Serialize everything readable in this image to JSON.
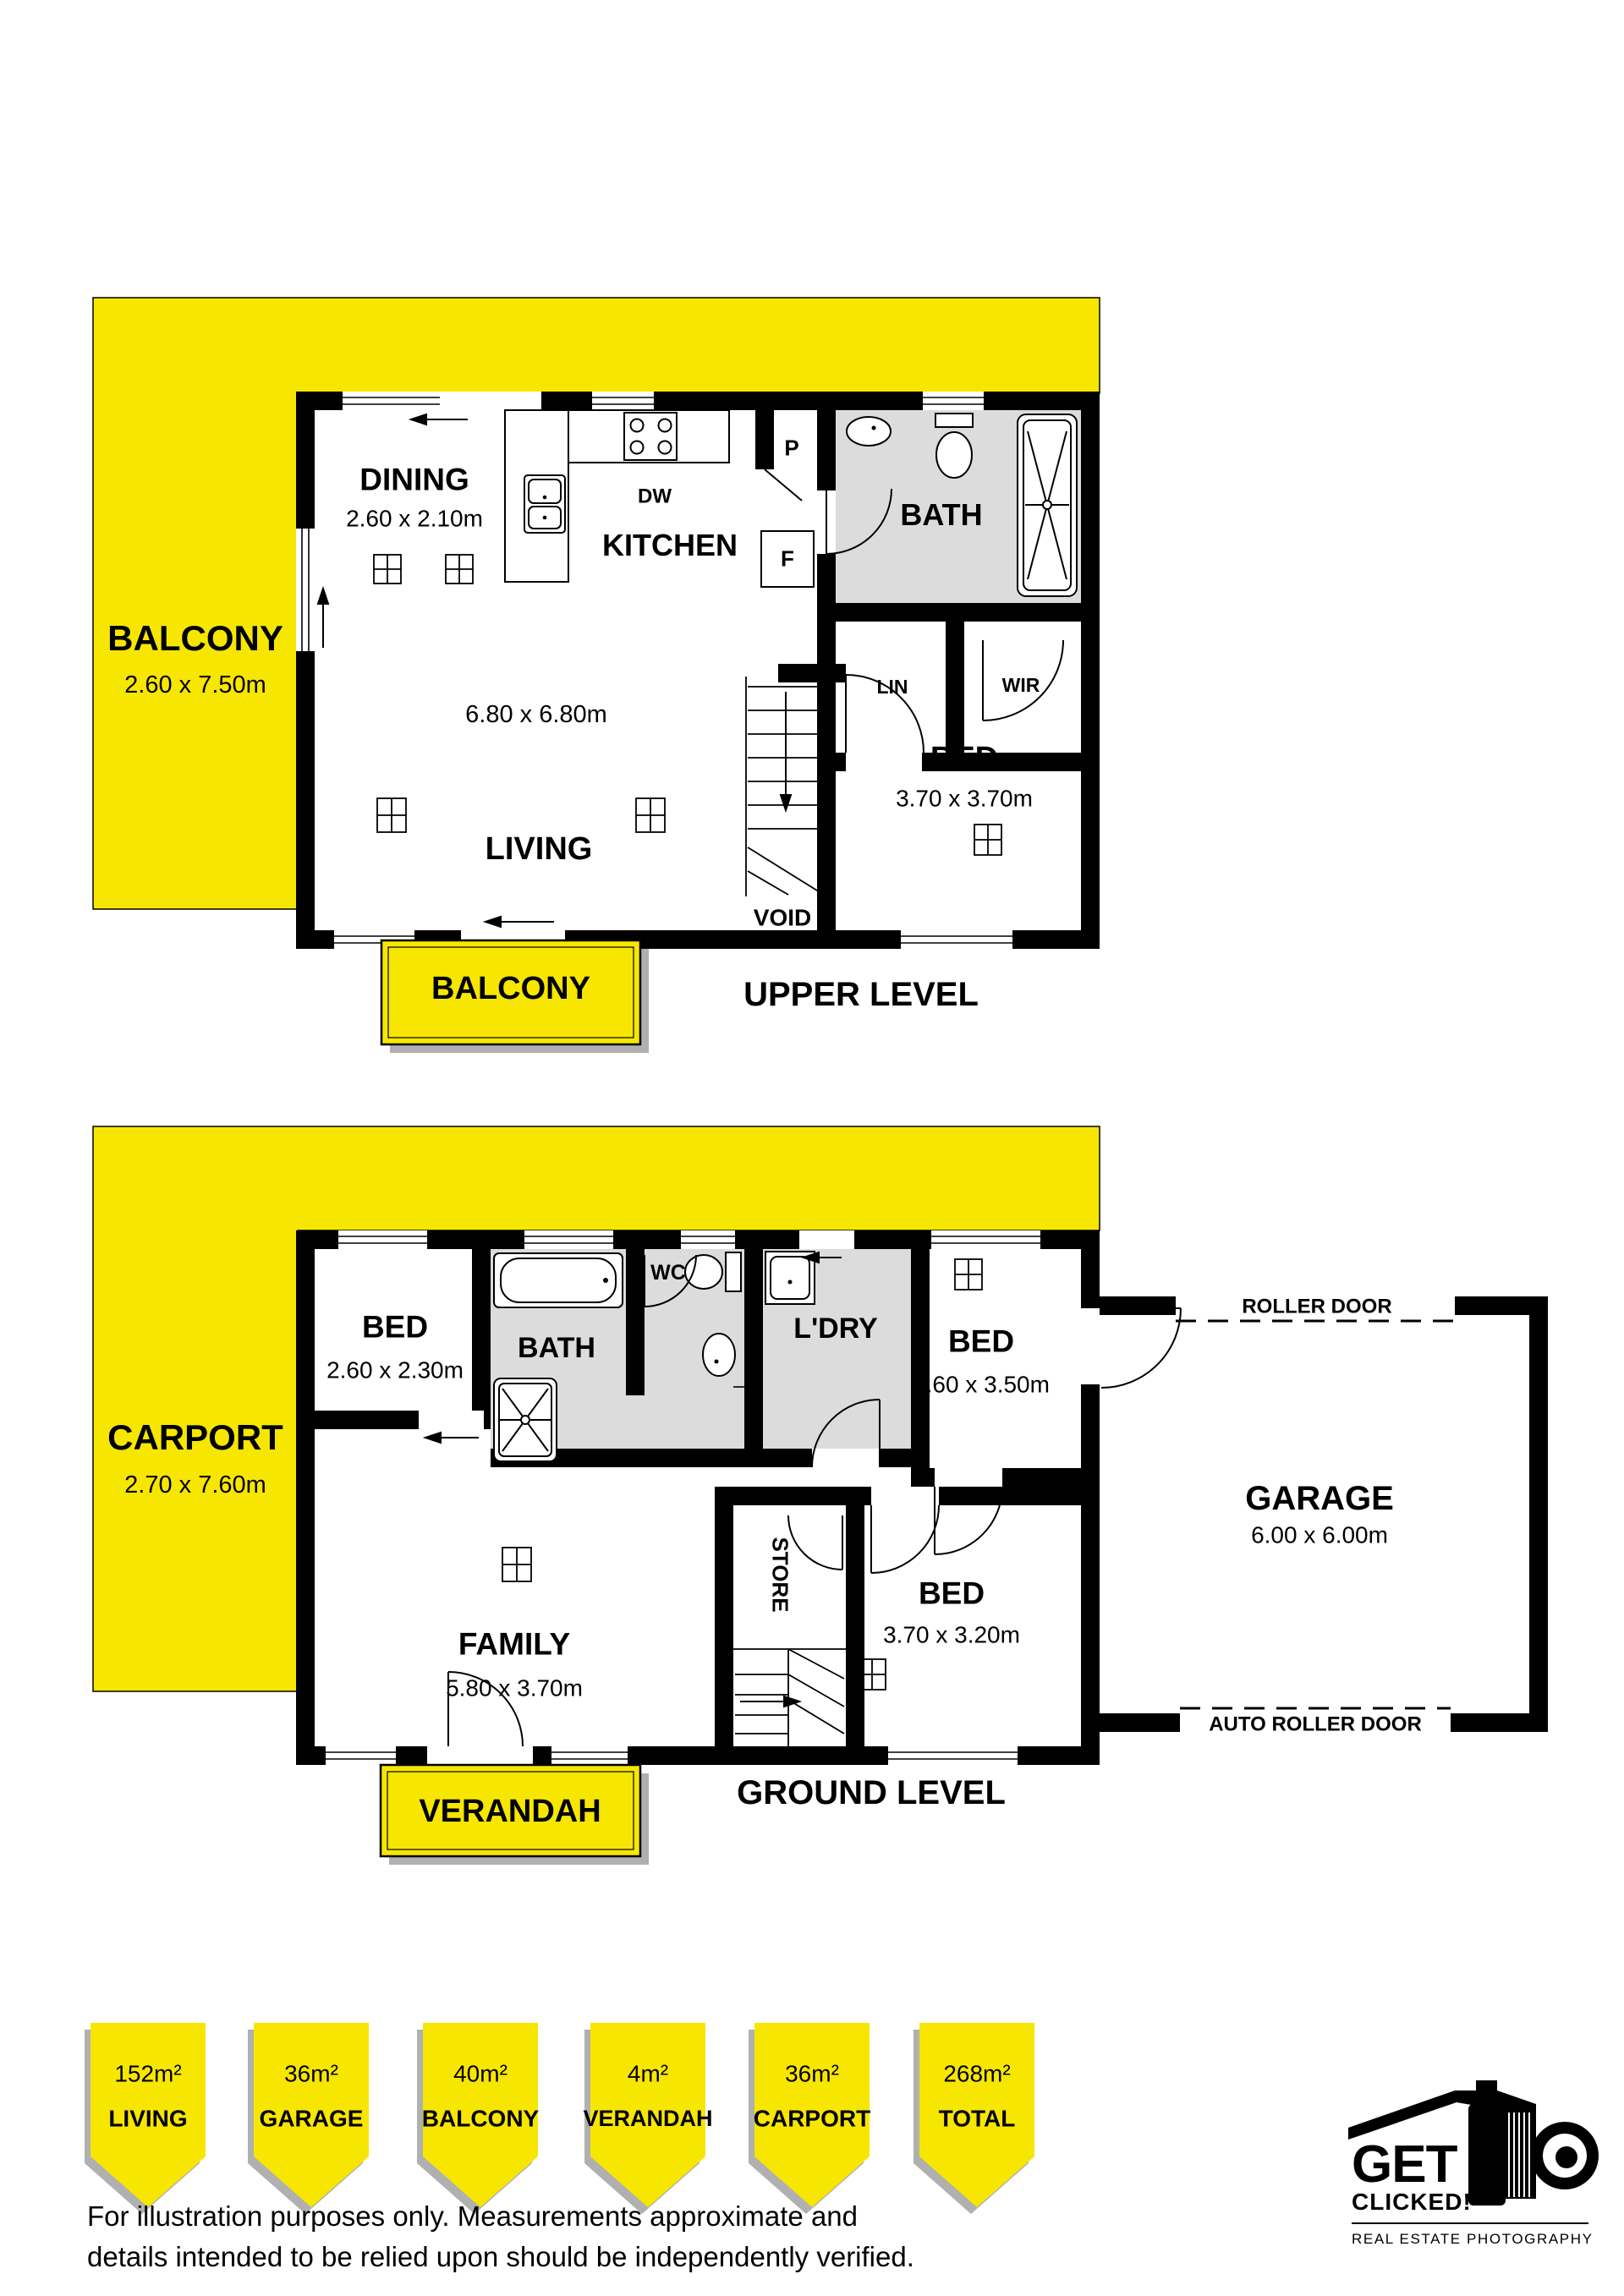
{
  "colors": {
    "yellow": "#F7E600",
    "bath_grey": "#DCDCDC",
    "wall": "#000000",
    "badge_shadow": "#B0B0B0"
  },
  "upper": {
    "balcony": {
      "label": "BALCONY",
      "dims": "2.60 x 7.50m"
    },
    "dining": {
      "label": "DINING",
      "dims": "2.60 x 2.10m"
    },
    "kitchen": {
      "label": "KITCHEN"
    },
    "dw": "DW",
    "p": "P",
    "f": "F",
    "bath": {
      "label": "BATH"
    },
    "lin": "LIN",
    "wir": "WIR",
    "bed": {
      "label": "BED",
      "dims": "3.70 x 3.70m"
    },
    "living": {
      "label": "LIVING",
      "overall_dims": "6.80 x 6.80m"
    },
    "void": "VOID",
    "balcony_badge": "BALCONY",
    "level": "UPPER LEVEL"
  },
  "ground": {
    "carport": {
      "label": "CARPORT",
      "dims": "2.70 x 7.60m"
    },
    "bed1": {
      "label": "BED",
      "dims": "2.60 x 2.30m"
    },
    "bath": {
      "label": "BATH"
    },
    "wc": "WC",
    "ldry": "L'DRY",
    "bed2": {
      "label": "BED",
      "dims": "2.60 x 3.50m"
    },
    "family": {
      "label": "FAMILY",
      "dims": "5.80 x 3.70m"
    },
    "store": "STORE",
    "bed3": {
      "label": "BED",
      "dims": "3.70 x 3.20m"
    },
    "garage": {
      "label": "GARAGE",
      "dims": "6.00 x 6.00m"
    },
    "roller_door": "ROLLER DOOR",
    "auto_roller_door": "AUTO ROLLER DOOR",
    "verandah_badge": "VERANDAH",
    "level": "GROUND LEVEL"
  },
  "badges": [
    {
      "value": "152m²",
      "label": "LIVING"
    },
    {
      "value": "36m²",
      "label": "GARAGE"
    },
    {
      "value": "40m²",
      "label": "BALCONY"
    },
    {
      "value": "4m²",
      "label": "VERANDAH"
    },
    {
      "value": "36m²",
      "label": "CARPORT"
    },
    {
      "value": "268m²",
      "label": "TOTAL"
    }
  ],
  "disclaimer": {
    "line1": "For illustration purposes only. Measurements approximate and",
    "line2": "details intended to be relied upon should be independently verified."
  },
  "logo": {
    "word1": "GET",
    "word2": "CLICKED!",
    "tagline": "REAL ESTATE PHOTOGRAPHY"
  }
}
